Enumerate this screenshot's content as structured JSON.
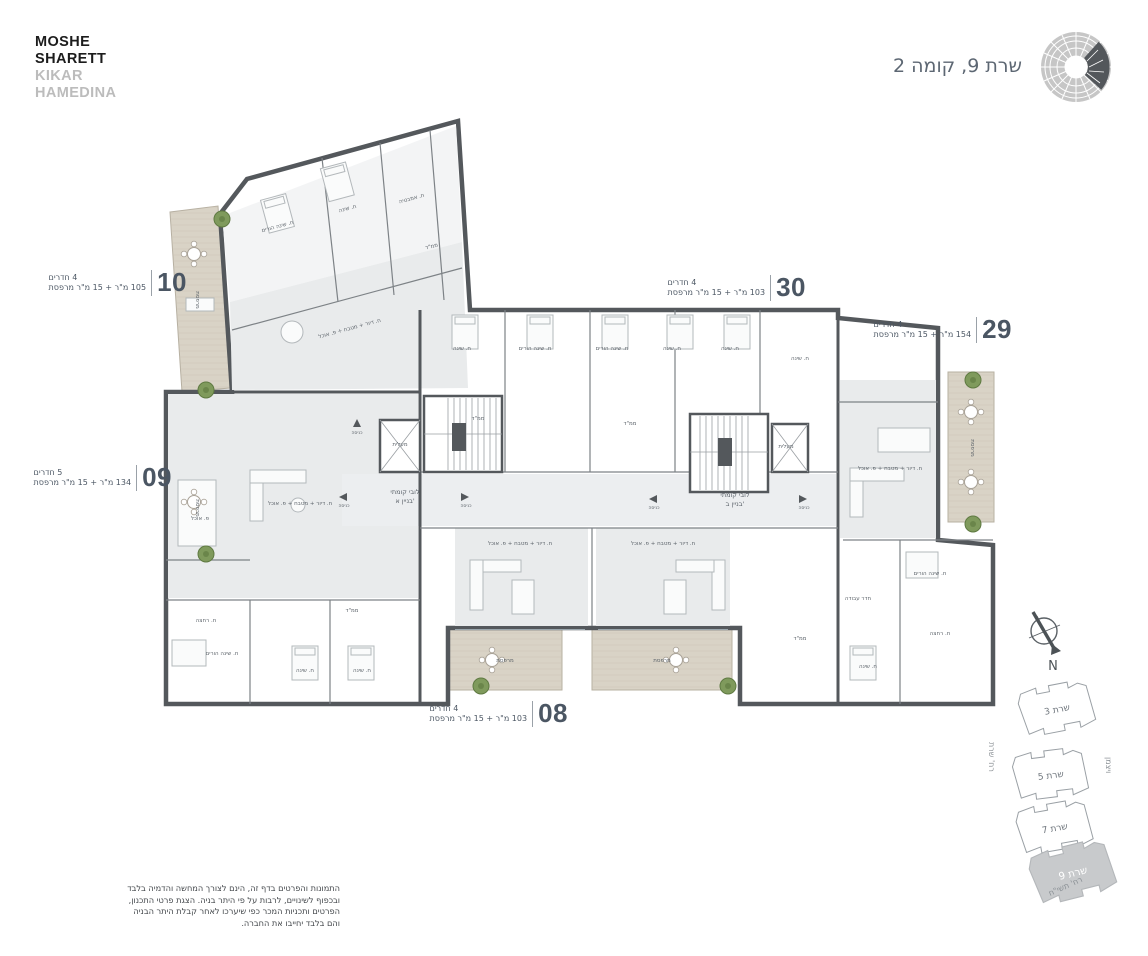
{
  "brand": {
    "line1": "MOSHE",
    "line2": "SHARETT",
    "line3": "KIKAR",
    "line4": "HAMEDINA"
  },
  "header": {
    "title": "שרת 9, קומה 2"
  },
  "units": [
    {
      "id": "10",
      "rooms": "4 חדרים",
      "area": "105 מ\"ר + 15 מ\"ר מרפסת"
    },
    {
      "id": "09",
      "rooms": "5 חדרים",
      "area": "134 מ\"ר + 15 מ\"ר מרפסת"
    },
    {
      "id": "30",
      "rooms": "4 חדרים",
      "area": "103 מ\"ר + 15 מ\"ר מרפסת"
    },
    {
      "id": "29",
      "rooms": "4 חדרים",
      "area": "154 מ\"ר + 15 מ\"ר מרפסת"
    },
    {
      "id": "08",
      "rooms": "4 חדרים",
      "area": "103 מ\"ר + 15 מ\"ר מרפסת"
    }
  ],
  "plan": {
    "room_labels": [
      {
        "t": "ח. שינה הורים",
        "x": 278,
        "y": 228,
        "r": -15
      },
      {
        "t": "ח. שינה",
        "x": 348,
        "y": 210,
        "r": -15
      },
      {
        "t": "ח. אמבטיה",
        "x": 412,
        "y": 200,
        "r": -15
      },
      {
        "t": "ממ\"ד",
        "x": 432,
        "y": 248,
        "r": -15
      },
      {
        "t": "ח. דיור + מטבח + פ. אוכל",
        "x": 350,
        "y": 330,
        "r": -15
      },
      {
        "t": "ח. דיור + מטבח + פ. אוכל",
        "x": 300,
        "y": 505
      },
      {
        "t": "פ. אוכל",
        "x": 200,
        "y": 520
      },
      {
        "t": "ח. רחצה",
        "x": 206,
        "y": 622
      },
      {
        "t": "ח. שינה הורים",
        "x": 222,
        "y": 655
      },
      {
        "t": "ח. שינה",
        "x": 305,
        "y": 672
      },
      {
        "t": "ח. שינה",
        "x": 362,
        "y": 672
      },
      {
        "t": "ממ\"ד",
        "x": 352,
        "y": 612
      },
      {
        "t": "ח. שינה",
        "x": 462,
        "y": 350
      },
      {
        "t": "ח. שינה הורים",
        "x": 535,
        "y": 350
      },
      {
        "t": "ח. שינה הורים",
        "x": 612,
        "y": 350
      },
      {
        "t": "ח. שינה",
        "x": 672,
        "y": 350
      },
      {
        "t": "ח. שינה",
        "x": 730,
        "y": 350
      },
      {
        "t": "ממ\"ד",
        "x": 478,
        "y": 420
      },
      {
        "t": "ממ\"ד",
        "x": 630,
        "y": 425
      },
      {
        "t": "ח. שינה",
        "x": 800,
        "y": 360
      },
      {
        "t": "מעלית",
        "x": 400,
        "y": 446
      },
      {
        "t": "מעלית",
        "x": 786,
        "y": 448
      },
      {
        "t": "לובי קומתי",
        "x": 405,
        "y": 494,
        "s": 6.5
      },
      {
        "t": "בניין א'",
        "x": 405,
        "y": 503,
        "s": 6.5
      },
      {
        "t": "לובי קומתי",
        "x": 735,
        "y": 497,
        "s": 6.5
      },
      {
        "t": "בניין ב'",
        "x": 735,
        "y": 506,
        "s": 6.5
      },
      {
        "t": "כניסה",
        "x": 357,
        "y": 434,
        "s": 4.5
      },
      {
        "t": "כניסה",
        "x": 344,
        "y": 507,
        "s": 4.5
      },
      {
        "t": "כניסה",
        "x": 466,
        "y": 507,
        "s": 4.5
      },
      {
        "t": "כניסה",
        "x": 654,
        "y": 509,
        "s": 4.5
      },
      {
        "t": "כניסה",
        "x": 804,
        "y": 509,
        "s": 4.5
      },
      {
        "t": "ח. דיור + מטבח + פ. אוכל",
        "x": 520,
        "y": 545
      },
      {
        "t": "ח. דיור + מטבח + פ. אוכל",
        "x": 663,
        "y": 545
      },
      {
        "t": "ח. דיור + מטבח + פ. אוכל",
        "x": 890,
        "y": 470
      },
      {
        "t": "ח. שינה הורים",
        "x": 930,
        "y": 575
      },
      {
        "t": "חדר עבודה",
        "x": 858,
        "y": 600
      },
      {
        "t": "ח. שינה",
        "x": 868,
        "y": 668
      },
      {
        "t": "ח. רחצה",
        "x": 940,
        "y": 635
      },
      {
        "t": "ממ\"ד",
        "x": 800,
        "y": 640
      },
      {
        "t": "מרפסת",
        "x": 196,
        "y": 300,
        "r": 90
      },
      {
        "t": "מרפסת",
        "x": 196,
        "y": 508,
        "r": 90
      },
      {
        "t": "מרפסת",
        "x": 971,
        "y": 448,
        "r": 90
      },
      {
        "t": "מרפסת",
        "x": 505,
        "y": 662
      },
      {
        "t": "מרפסת",
        "x": 662,
        "y": 662
      }
    ]
  },
  "compass": {
    "north_label": "N"
  },
  "keymap": {
    "buildings": [
      {
        "label": "שרת 3"
      },
      {
        "label": "שרת 5"
      },
      {
        "label": "שרת 7"
      },
      {
        "label": "שרת 9",
        "highlighted": true
      }
    ],
    "street_left": "רח' שרת",
    "street_right": "ויצמן",
    "street_bottom": "רח' תשי\"ח"
  },
  "disclaimer": {
    "lines": [
      "התמונות והפרטים בדף זה, הינם לצורך המחשה והדמיה בלבד",
      "ובכפוף לשינויים, לרבות על פי היתר בניה. הצגת פרטי התכנון,",
      "הפרטים ותכניות המכר כפי שיערכו לאחר קבלת היתר הבניה",
      "והם בלבד יחייבו את החברה."
    ]
  },
  "colors": {
    "wall": "#54585c",
    "room_gray": "#e9ebec",
    "corridor_gray": "#eceef0",
    "balcony": "#d9d3c6",
    "accent_text": "#4b5663",
    "tree": "#7f9a5c",
    "keymap_highlight": "#c8cacc"
  }
}
